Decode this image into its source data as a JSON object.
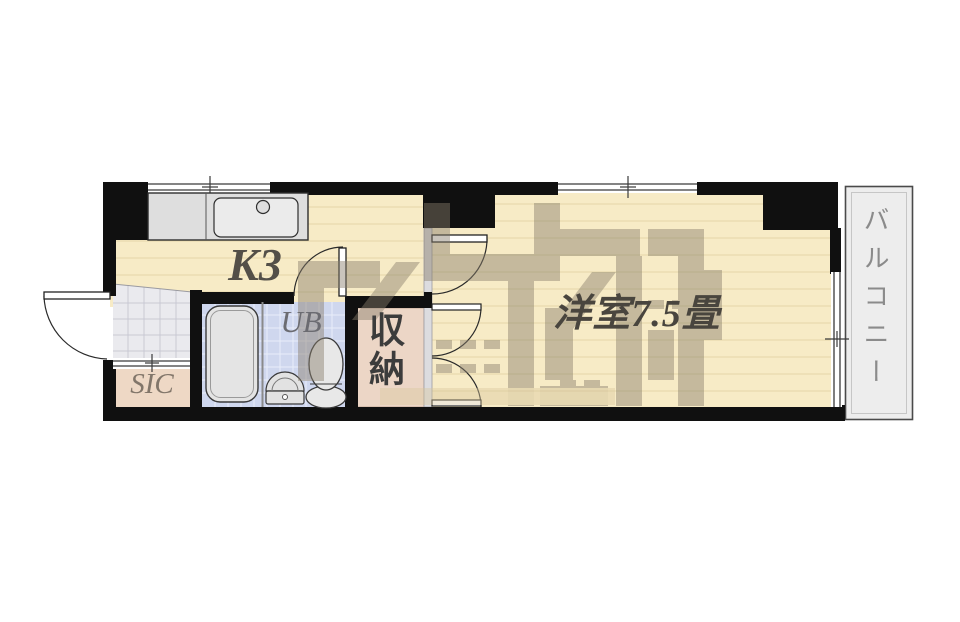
{
  "rooms": {
    "kitchen": {
      "label": "K3"
    },
    "western_room": {
      "label": "洋室7.5畳"
    },
    "balcony": {
      "label": "バルコニー"
    },
    "unit_bath": {
      "label": "UB"
    },
    "storage": {
      "label": "収納"
    },
    "shoe_closet": {
      "label": "SIC"
    }
  },
  "fixtures": [
    "kitchen-sink",
    "bathtub",
    "washbasin",
    "toilet"
  ],
  "openings": [
    "entrance-door",
    "unit-bath-door",
    "room-entry-door",
    "closet-double-doors",
    "kitchen-window",
    "main-room-window",
    "balcony-window",
    "entrance-closet-sliding-door"
  ],
  "colors": {
    "wall": "#101010",
    "wood_floor": "#f7ebc6",
    "floor_line": "#e8daae",
    "entrance_tile": "#eaeaee",
    "sic_floor": "#eed8c5",
    "storage_floor": "#ecd6c6",
    "bath_tile": "#cfd7ee",
    "fixture_gray": "#e4e4e4",
    "balcony_floor": "#ededed",
    "label_dark": "#49453e",
    "label_gray": "#8b8b8b",
    "watermark": "#897e6c"
  }
}
